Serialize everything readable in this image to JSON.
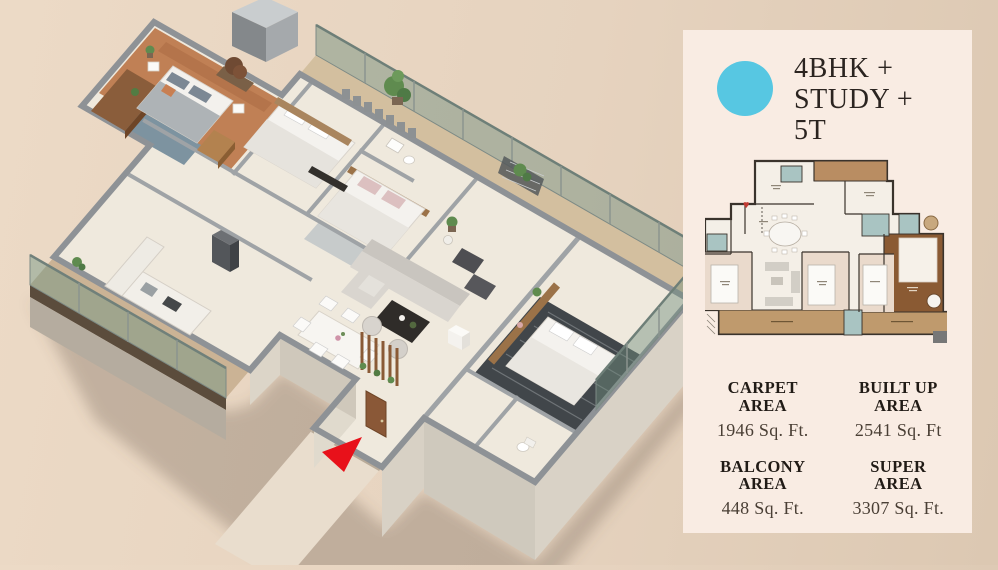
{
  "colors": {
    "page-bg-left": "#ecdac6",
    "page-bg-right": "#dcc8b2",
    "panel-bg": "#f9ece3",
    "accent-cyan": "#57c7e2",
    "arrow-red": "#e8111a",
    "title-color": "#2b2420",
    "label-color": "#211b16",
    "value-color": "#4a3f35"
  },
  "panel": {
    "title_lines": [
      "4BHK +",
      "STUDY +",
      "5T"
    ],
    "stats": [
      {
        "line1": "CARPET",
        "line2": "AREA",
        "value": "1946 Sq. Ft."
      },
      {
        "line1": "BUILT UP",
        "line2": "AREA",
        "value": "2541 Sq. Ft"
      },
      {
        "line1": "BALCONY",
        "line2": "AREA",
        "value": "448 Sq. Ft."
      },
      {
        "line1": "SUPER",
        "line2": "AREA",
        "value": "3307 Sq. Ft."
      }
    ]
  },
  "floor_plan_3d": {
    "type": "isometric 3D apartment render",
    "entrance_marker": "red arrow at main entrance door"
  }
}
